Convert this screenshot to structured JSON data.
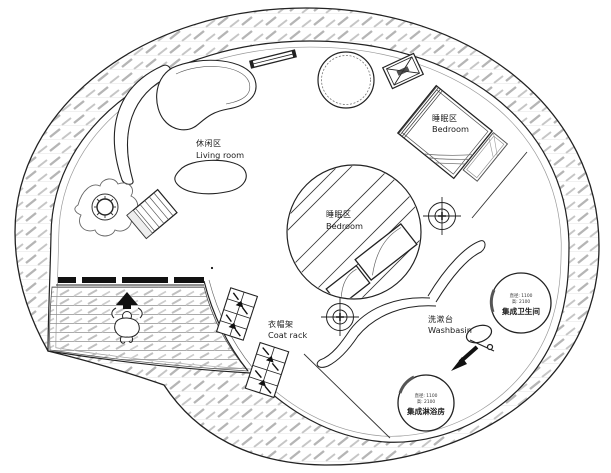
{
  "colors": {
    "line": "#222222",
    "hatch": "#b8b8b8",
    "black_fill": "#111111",
    "bg": "#ffffff"
  },
  "areas": {
    "living_room": {
      "zh": "休闲区",
      "en": "Living room"
    },
    "bedroom_upper": {
      "zh": "睡眠区",
      "en": "Bedroom"
    },
    "bedroom_center": {
      "zh": "睡眠区",
      "en": "Bedroom"
    },
    "coat_rack": {
      "zh": "衣帽架",
      "en": "Coat rack"
    },
    "washbasin": {
      "zh": "洗漱台",
      "en": "Washbasin"
    },
    "bathroom_pod": {
      "dim_diameter": "直径: 1100",
      "dim_height": "高: 2100",
      "zh": "集成卫生间"
    },
    "shower_pod": {
      "dim_diameter": "直径: 1100",
      "dim_height": "高: 2100",
      "zh": "集成淋浴房"
    }
  },
  "icons": {
    "survey_marker": "crosshair-target",
    "ac_unit": "crossed-box",
    "entrance_arrow": "up-arrow",
    "pod_arrow": "direction-arrow",
    "hook": "loop-hook"
  }
}
